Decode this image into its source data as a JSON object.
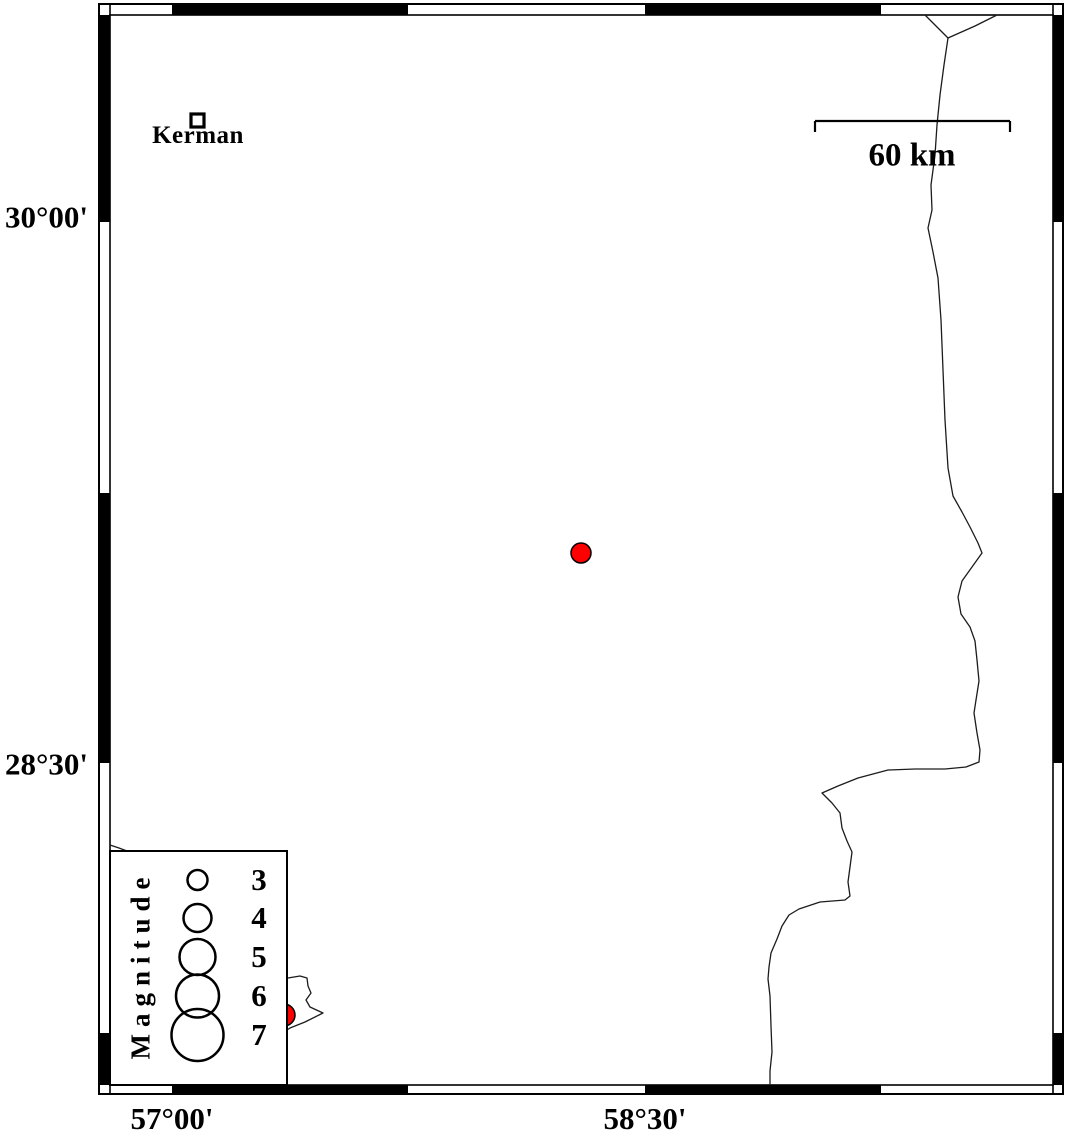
{
  "map": {
    "kind": "earthquake-epicenter-map",
    "background_color": "#ffffff",
    "frame_style": "fancy alternating black/white degree border"
  },
  "axis": {
    "lat_labels": [
      {
        "text": "30°00'"
      },
      {
        "text": "28°30'"
      }
    ],
    "lon_labels": [
      {
        "text": "57°00'"
      },
      {
        "text": "58°30'"
      }
    ]
  },
  "city": {
    "name": "Kerman",
    "marker": "open-square"
  },
  "scalebar": {
    "label": "60 km",
    "length_px": 195
  },
  "legend": {
    "title": "Magnitude",
    "entries": [
      {
        "magnitude": "3",
        "radius_px": 10
      },
      {
        "magnitude": "4",
        "radius_px": 14
      },
      {
        "magnitude": "5",
        "radius_px": 18
      },
      {
        "magnitude": "6",
        "radius_px": 21.5
      },
      {
        "magnitude": "7",
        "radius_px": 26
      }
    ]
  },
  "epicenters": [
    {
      "x": 581,
      "y": 553,
      "radius": 10,
      "color": "#ff0000"
    },
    {
      "x": 284,
      "y": 1015,
      "radius": 11,
      "color": "#ff0000"
    }
  ],
  "colors": {
    "epicenter": "#ff0000",
    "ink": "#000000",
    "boundary_line": "#1c1c1c"
  }
}
